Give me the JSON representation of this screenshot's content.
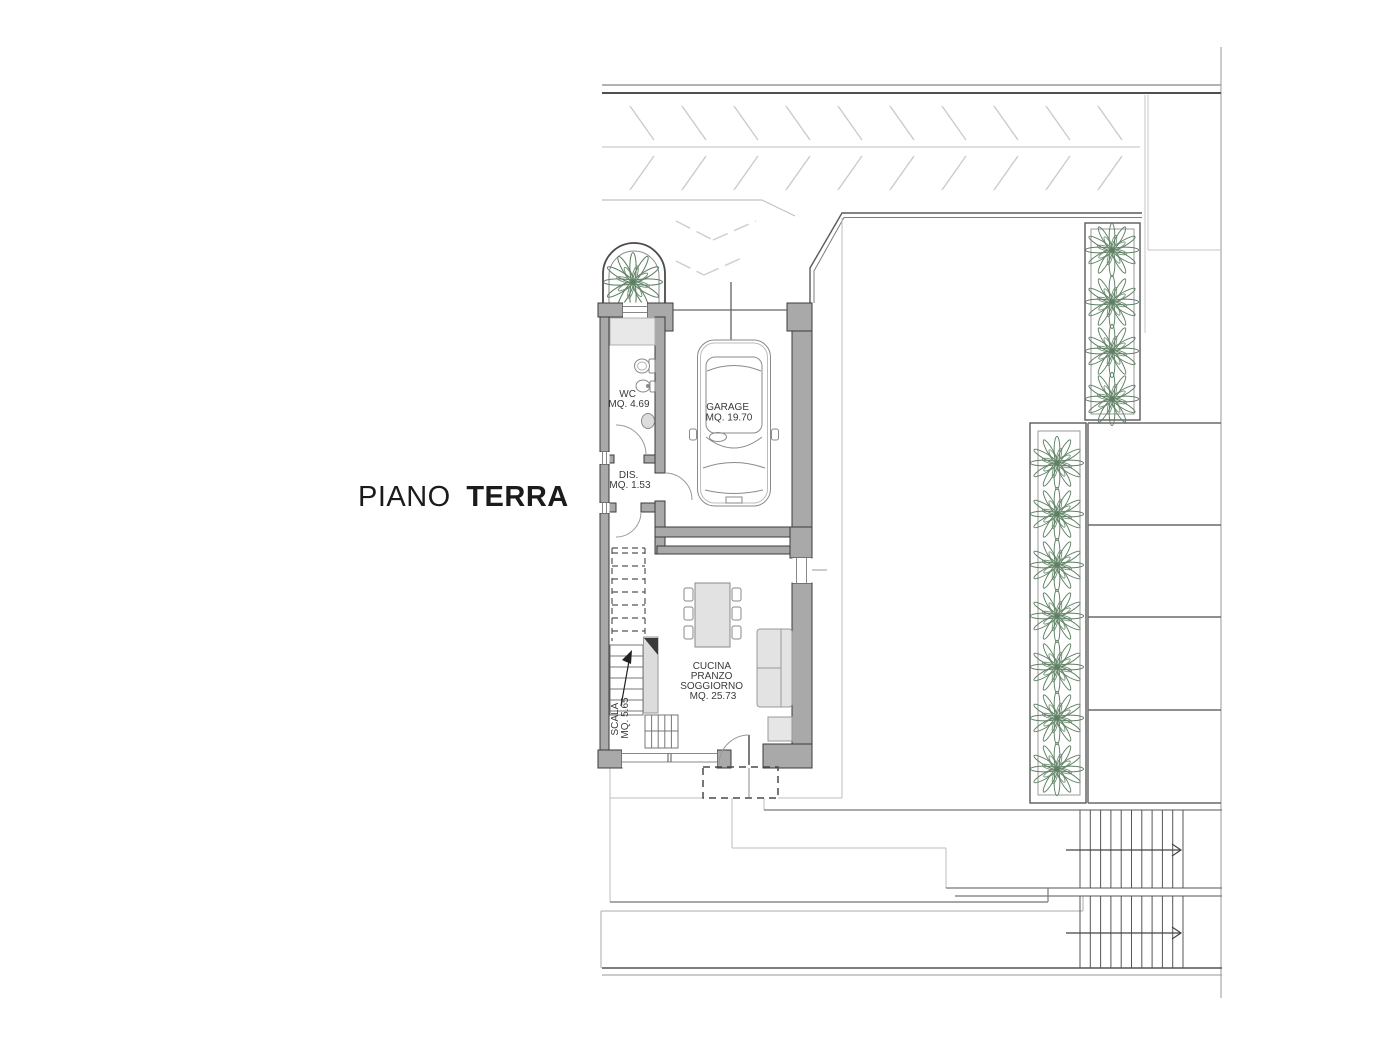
{
  "title": {
    "prefix": "PIANO",
    "emphasis": "TERRA"
  },
  "floor_plan": {
    "rooms": [
      {
        "name": "WC",
        "area": "MQ. 4.69"
      },
      {
        "name": "DIS.",
        "area": "MQ. 1.53"
      },
      {
        "name": "GARAGE",
        "area": "MQ. 19.70"
      },
      {
        "name_lines": [
          "CUCINA",
          "PRANZO",
          "SOGGIORNO"
        ],
        "area": "MQ. 25.73"
      },
      {
        "name": "SCALA",
        "area": "MQ. 5.65"
      }
    ],
    "symbols": {
      "car": "car-top-view-symbol",
      "plant": "shrub-plan-symbol",
      "stairs_arrow": "direction-arrow-symbol",
      "parking": "diagonal-hatch-parking"
    },
    "colors": {
      "wall_fill": "#a9a9a9",
      "wall_stroke": "#3b3b3b",
      "line_dark": "#555555",
      "line_medium": "#8a8a8a",
      "line_light": "#b9b9b9",
      "hatch": "#c9c9c9",
      "plant_green": "#5f7f63",
      "furniture_fill": "#e3e3e3",
      "label_text": "#3a3a3a",
      "title_text": "#1b1b1b"
    }
  }
}
